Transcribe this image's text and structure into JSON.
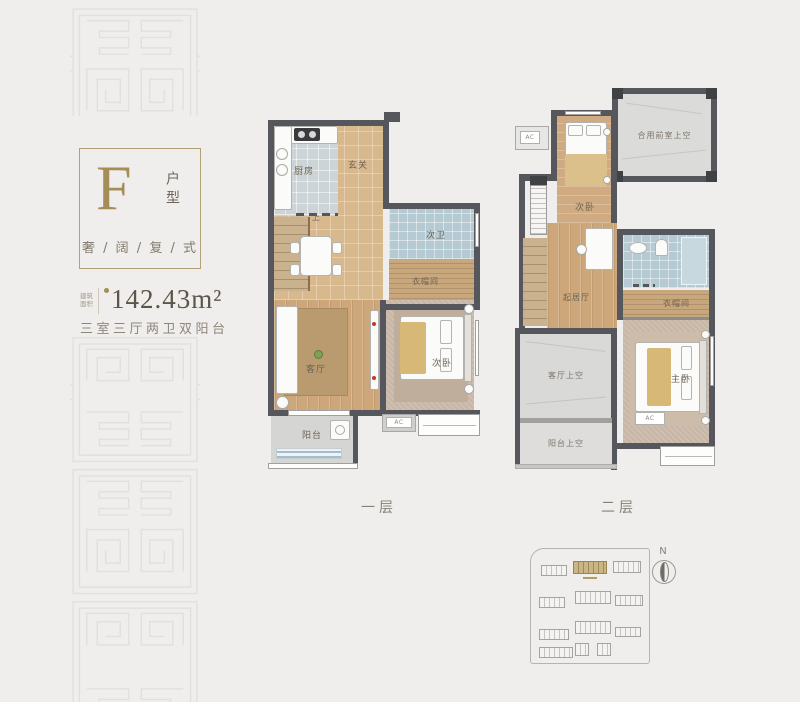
{
  "info_panel": {
    "type_letter": "F",
    "type_label_vertical": "户型",
    "tagline": "奢 / 阔 / 复 / 式",
    "area_caption_line1": "建筑",
    "area_caption_line2": "面积",
    "area_value": "142.43m²",
    "layout_summary": "三室三厅两卫双阳台"
  },
  "floor1": {
    "caption": "一层",
    "ac_label": "AC",
    "rooms": {
      "kitchen": "厨房",
      "entry": "玄关",
      "stairs_up": "上",
      "second_bath": "次卫",
      "cloakroom": "衣帽间",
      "living": "客厅",
      "second_bedroom": "次卧",
      "balcony": "阳台"
    }
  },
  "floor2": {
    "caption": "二层",
    "ac_label": "AC",
    "rooms": {
      "shared_front_void": "合用前室上空",
      "second_bedroom": "次卧",
      "sitting": "起居厅",
      "cloakroom": "衣帽间",
      "master_bedroom": "主卧",
      "living_void": "客厅上空",
      "balcony_void": "阳台上空"
    }
  },
  "site_plan": {
    "north_label": "N"
  },
  "colors": {
    "background": "#efeeec",
    "accent_gold": "#a58d58",
    "wall": "#56575c",
    "wood": "#cda67a",
    "bath_tile": "#b6cad3"
  }
}
